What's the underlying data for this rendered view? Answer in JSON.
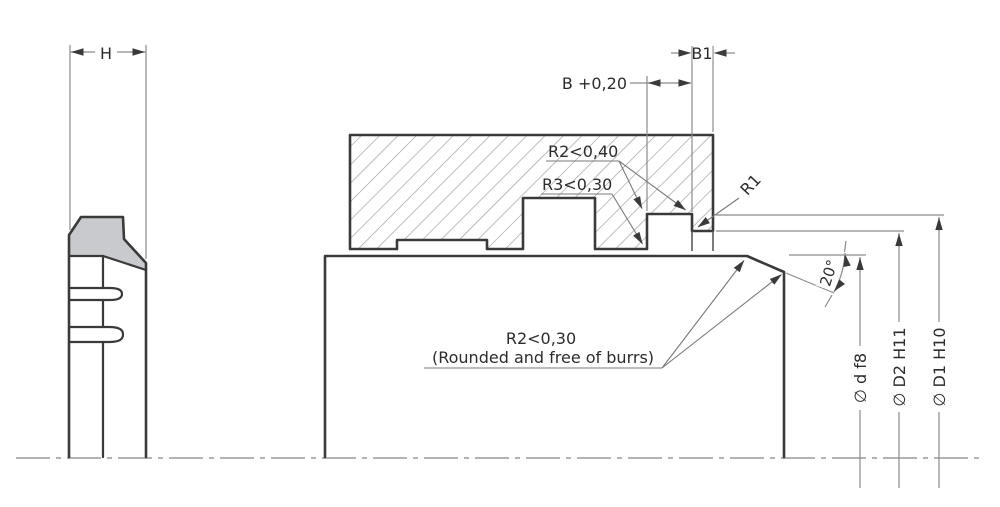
{
  "drawing": {
    "title_hint": "Wiper seal groove installation drawing",
    "left_profile": {
      "height_label": "H"
    },
    "groove": {
      "width_label": "B +0,20",
      "land_label": "B1",
      "root_radius_label": "R2<0,40",
      "opening_radius_label": "R3<0,30",
      "front_radius_label": "R1"
    },
    "rod": {
      "chamfer_angle_label": "20°",
      "edge_note_line1": "R2<0,30",
      "edge_note_line2": "(Rounded and free of burrs)"
    },
    "diameters": {
      "rod_dia_label": "∅ d f8",
      "land_dia_label": "∅ D2 H11",
      "groove_dia_label": "∅ D1 H10"
    },
    "colors": {
      "object_line": "#3a3a3a",
      "thin_line": "#8b8b8b",
      "hatch_line": "#9b9b9b",
      "seal_fill": "#c9cacd",
      "background": "#ffffff"
    }
  }
}
